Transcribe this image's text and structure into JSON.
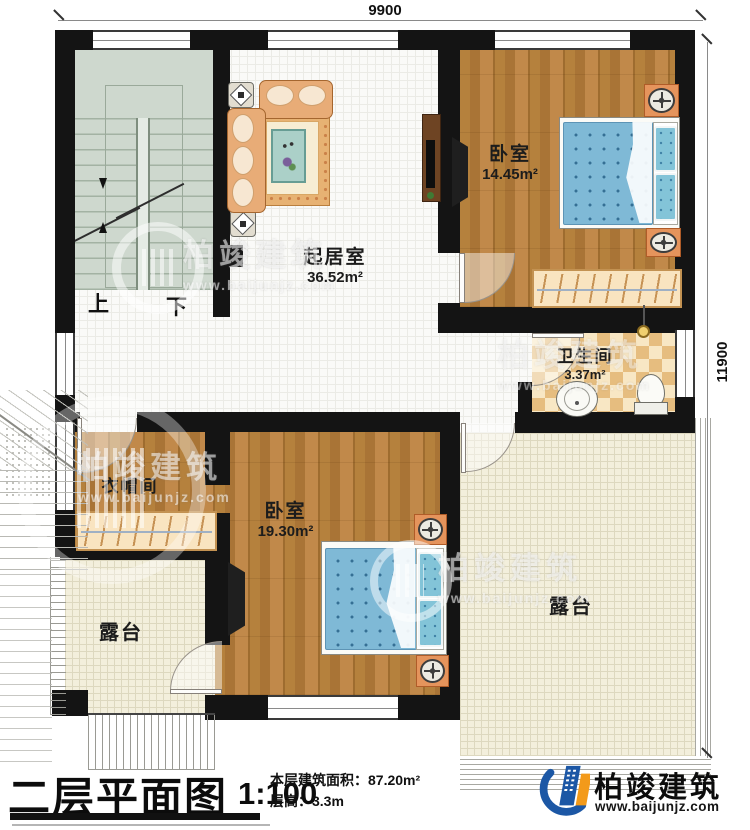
{
  "dimensions": {
    "top": "9900",
    "right": "11900"
  },
  "rooms": {
    "stair_up": "上",
    "stair_down": "下",
    "living": {
      "name": "起居室",
      "area": "36.52m²"
    },
    "bedroom1": {
      "name": "卧室",
      "area": "14.45m²"
    },
    "bathroom": {
      "name": "卫生间",
      "area": "3.37m²"
    },
    "cloakroom": {
      "name": "衣帽间"
    },
    "bedroom2": {
      "name": "卧室",
      "area": "19.30m²"
    },
    "terrace_left": {
      "name": "露台"
    },
    "terrace_right": {
      "name": "露台"
    }
  },
  "titleblock": {
    "title": "二层平面图",
    "scale": "1:100",
    "area_label": "本层建筑面积：87.20m²",
    "height_label": "层高：3.3m"
  },
  "brand": {
    "name": "柏竣建筑",
    "website": "www.baijunjz.com"
  },
  "watermark": {
    "text": "柏竣建筑",
    "url": "www.baijunjz.com"
  },
  "colors": {
    "wall": "#141414",
    "wood": "#b5813d",
    "bed_blue": "#7fb9d6",
    "checker": "#e6bd7f",
    "terrace": "#f3efdc",
    "logo_blue": "#1c57a5",
    "logo_orange": "#f39a1a"
  }
}
